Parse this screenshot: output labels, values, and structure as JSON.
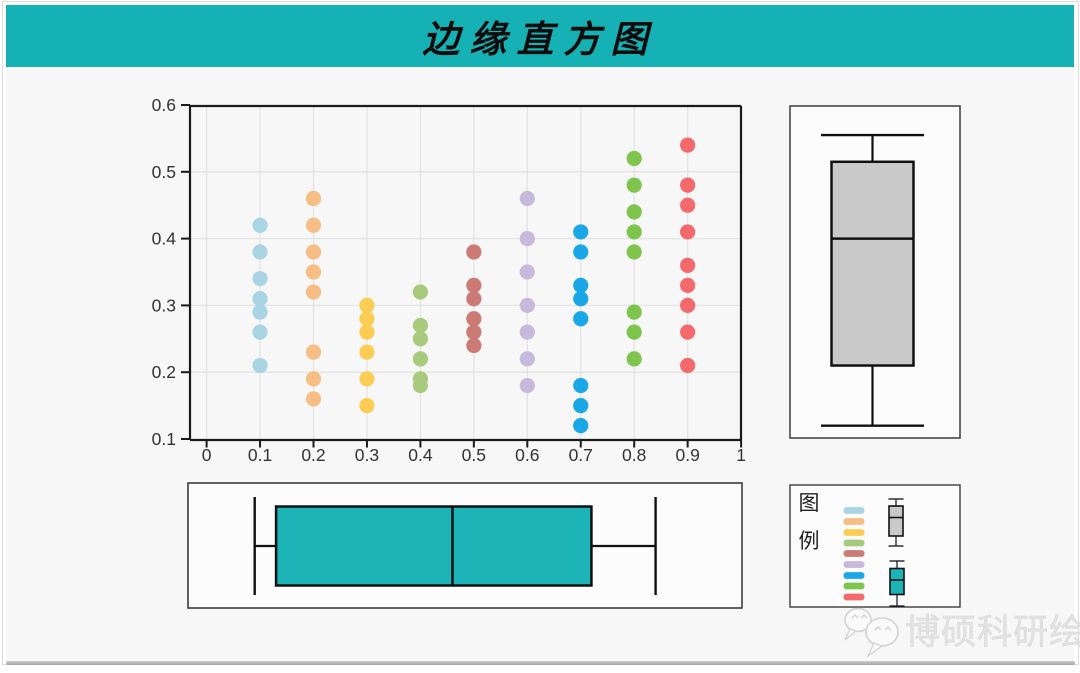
{
  "header": {
    "title": "边缘直方图"
  },
  "footer": {
    "watermark_text": "博硕科研绘图",
    "watermark_icon": "wechat-chat-bubbles-icon"
  },
  "colors": {
    "titlebar_teal": "#15b1b5",
    "page_bg": "#f7f7f7",
    "panel_bg": "#fcfcfc",
    "panel_border": "#3c3c3c",
    "axis_line": "#1a1a1a",
    "gridline": "#e4e4e4",
    "tick_label": "#333333",
    "box_gray_fill": "#c9c9c9",
    "box_teal_fill": "#1cb4b6",
    "box_stroke": "#111111",
    "watermark_gray": "#e3e3e3"
  },
  "chart_data": {
    "type": "scatter",
    "subtype": "scatter-with-marginal-boxplots",
    "title": "边缘直方图",
    "grid": "on",
    "x_axis": {
      "range": [
        0,
        1
      ],
      "tick_values": [
        0,
        0.1,
        0.2,
        0.3,
        0.4,
        0.5,
        0.6,
        0.7,
        0.8,
        0.9,
        1
      ],
      "tick_labels": [
        "0",
        "0.1",
        "0.2",
        "0.3",
        "0.4",
        "0.5",
        "0.6",
        "0.7",
        "0.8",
        "0.9",
        "1"
      ]
    },
    "y_axis": {
      "range": [
        0.1,
        0.6
      ],
      "tick_values": [
        0.1,
        0.2,
        0.3,
        0.4,
        0.5,
        0.6
      ],
      "tick_labels": [
        "0.1",
        "0.2",
        "0.3",
        "0.4",
        "0.5",
        "0.6"
      ]
    },
    "series": [
      {
        "name": "x=0.1",
        "x": 0.1,
        "color": "#a9d4e4",
        "y": [
          0.42,
          0.38,
          0.34,
          0.31,
          0.29,
          0.26,
          0.21
        ]
      },
      {
        "name": "x=0.2",
        "x": 0.2,
        "color": "#f6bd85",
        "y": [
          0.46,
          0.42,
          0.38,
          0.35,
          0.32,
          0.23,
          0.19,
          0.16
        ]
      },
      {
        "name": "x=0.3",
        "x": 0.3,
        "color": "#fbcd55",
        "y": [
          0.3,
          0.28,
          0.26,
          0.23,
          0.19,
          0.15
        ]
      },
      {
        "name": "x=0.4",
        "x": 0.4,
        "color": "#a7ca7d",
        "y": [
          0.32,
          0.27,
          0.25,
          0.22,
          0.19,
          0.18
        ]
      },
      {
        "name": "x=0.5",
        "x": 0.5,
        "color": "#cb7a76",
        "y": [
          0.38,
          0.33,
          0.31,
          0.28,
          0.26,
          0.24
        ]
      },
      {
        "name": "x=0.6",
        "x": 0.6,
        "color": "#c7b9dc",
        "y": [
          0.46,
          0.4,
          0.35,
          0.3,
          0.26,
          0.22,
          0.18
        ]
      },
      {
        "name": "x=0.7",
        "x": 0.7,
        "color": "#1aa7e8",
        "y": [
          0.41,
          0.38,
          0.33,
          0.31,
          0.28,
          0.18,
          0.15,
          0.12
        ]
      },
      {
        "name": "x=0.8",
        "x": 0.8,
        "color": "#7ec44d",
        "y": [
          0.52,
          0.48,
          0.44,
          0.41,
          0.38,
          0.29,
          0.26,
          0.22
        ]
      },
      {
        "name": "x=0.9",
        "x": 0.9,
        "color": "#f4696b",
        "y": [
          0.54,
          0.48,
          0.45,
          0.41,
          0.36,
          0.33,
          0.3,
          0.26,
          0.21
        ]
      }
    ],
    "marginal_boxplot_right": {
      "orientation": "vertical",
      "axis": "y",
      "fill": "#c9c9c9",
      "min": 0.12,
      "q1": 0.21,
      "median": 0.4,
      "q3": 0.515,
      "max": 0.555
    },
    "marginal_boxplot_bottom": {
      "orientation": "horizontal",
      "axis": "x",
      "fill": "#1cb4b6",
      "min": 0.09,
      "q1": 0.13,
      "median": 0.46,
      "q3": 0.72,
      "max": 0.84
    },
    "legend": {
      "label_chars": [
        "图",
        "例"
      ],
      "swatch_colors": [
        "#a9d4e4",
        "#f6bd85",
        "#fbcd55",
        "#a7ca7d",
        "#cb7a76",
        "#c7b9dc",
        "#1aa7e8",
        "#7ec44d",
        "#f4696b"
      ],
      "glyphs": [
        "gray-vertical-boxplot",
        "teal-vertical-boxplot"
      ],
      "position": "bottom-right"
    }
  }
}
